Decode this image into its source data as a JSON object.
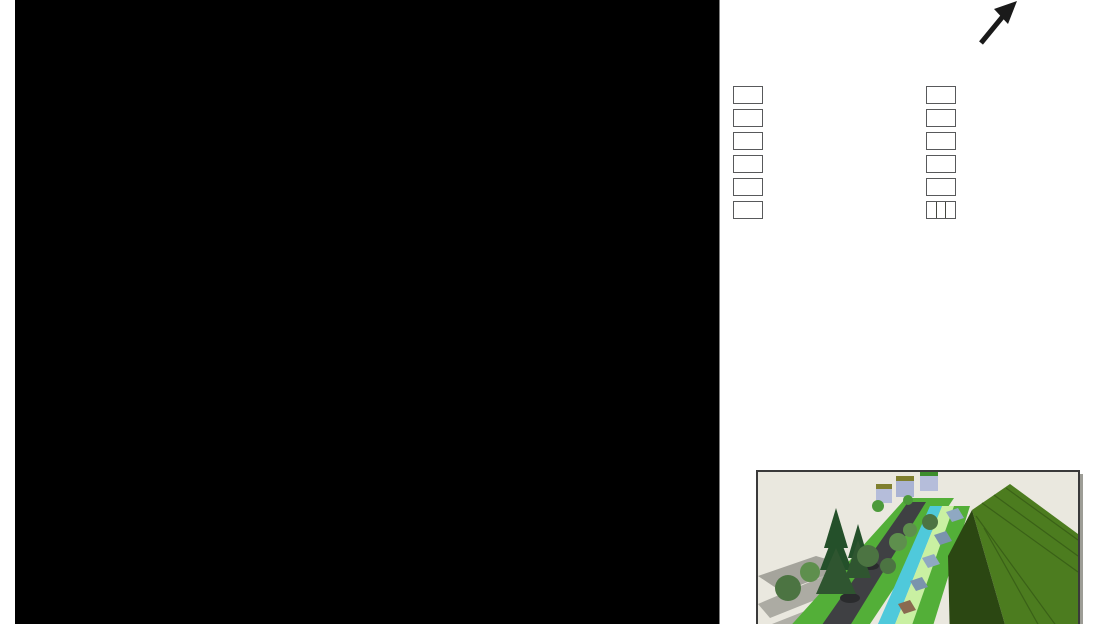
{
  "scale_label": "Schaal 1:250",
  "north_label": "N",
  "palette": {
    "groendak1": "#179551",
    "groendak2": "#6f6b33",
    "kas-light": "#bce2f1",
    "kas-dark": "#9cbdcb",
    "openbaar": "#8cc75b",
    "water": "#199fdb",
    "wegen": "#57585b",
    "voetpad": "#7f8285",
    "brug": "#8a6a50",
    "onverhard": "#dee67c",
    "verhard": "#acacae",
    "parkeer": "#8f8e75",
    "tree-bright": "#1cb053",
    "tree-mid": "#4e8c36",
    "tree-dark": "#546f4b",
    "outline": "#2b2b2b"
  },
  "legend": {
    "column1": [
      {
        "label": "Groendak type 1",
        "color": "#179551"
      },
      {
        "label": "Groendak type 2",
        "color": "#6f6b33"
      },
      {
        "label": "Kasgedeelte",
        "color": "#c9e6f4"
      },
      {
        "label": "Openbare buitenruimte",
        "color": "#8cc75b"
      },
      {
        "label": "Water",
        "color": "#199fdb"
      },
      {
        "label": "Wegen",
        "color": "#57585b"
      }
    ],
    "column2": [
      {
        "label": "Voetpaden",
        "color": "#7f8285"
      },
      {
        "label": "Brug",
        "color": "#8a6a50"
      },
      {
        "label": "Kavel onverhard",
        "color": "#dee67c"
      },
      {
        "label": "Kavel verhard",
        "color": "#acacae"
      },
      {
        "label": "Parkeerplaats",
        "color": "#8f8e75"
      },
      {
        "label": "Verschillende soorten bomen",
        "colors": [
          "#4e8c36",
          "#5d7052",
          "#22b14c"
        ]
      }
    ]
  },
  "description": {
    "lines": [
      "De afbeelding links is een detailtekening van de ingegraven",
      "woningen en de twee-onder-één kap woning op schaal",
      "1:250. Te zien is ook de 2 groene stroken langs de weg, met",
      "daaraan langsparkeren, de verschillende type groene daken",
      "en de variatie in bomen."
    ]
  },
  "map": {
    "greenhouses": [
      {
        "x1": 55.5,
        "x2": 205.5,
        "y1": 43,
        "y2": 89,
        "pattern": "dddddlllll"
      },
      {
        "x1": 262,
        "x2": 415,
        "y1": 43,
        "y2": 89,
        "pattern": "ddlddlldll"
      },
      {
        "x1": 472,
        "x2": 622,
        "y1": 43,
        "y2": 89,
        "pattern": "dddddlllll"
      },
      {
        "x1": 680,
        "x2": 719.5,
        "y1": 43,
        "y2": 89,
        "pattern": "dll"
      }
    ],
    "yellow_squares": [
      87,
      295,
      502,
      707
    ],
    "yellow_bars": [
      [
        87,
        205.5
      ],
      [
        295,
        413
      ],
      [
        502,
        622
      ],
      [
        707,
        719.5
      ]
    ],
    "block_lines": [
      205.5,
      415,
      622
    ],
    "bridges": [
      [
        15,
        43
      ],
      [
        208,
        250
      ],
      [
        415,
        457
      ],
      [
        624,
        666
      ]
    ],
    "strip_segments": [
      [
        43,
        208
      ],
      [
        250,
        415
      ],
      [
        457,
        624
      ],
      [
        666,
        719.5
      ]
    ],
    "parkeer": [
      [
        18,
        85,
        327,
        353
      ],
      [
        293,
        370,
        327,
        353
      ],
      [
        483,
        553,
        325,
        354
      ],
      [
        557,
        628,
        325,
        354
      ],
      [
        632,
        703,
        325,
        354
      ]
    ],
    "trees": [
      {
        "cx": 105,
        "cy": 252,
        "rx": 30,
        "ry": 42,
        "tone": "bright"
      },
      {
        "cx": 255,
        "cy": 238,
        "rx": 61,
        "ry": 62,
        "tone": "mid"
      },
      {
        "cx": 365,
        "cy": 255,
        "rx": 32,
        "ry": 43,
        "tone": "bright"
      },
      {
        "cx": 602,
        "cy": 266,
        "rx": 45,
        "ry": 52,
        "tone": "dark"
      },
      {
        "cx": 190,
        "cy": 368,
        "rx": 45,
        "ry": 45,
        "tone": "dark"
      },
      {
        "cx": 536,
        "cy": 451,
        "rx": 60,
        "ry": 60,
        "tone": "mid"
      },
      {
        "cx": 668,
        "cy": 453,
        "rx": 30,
        "ry": 30,
        "tone": "bright"
      },
      {
        "cx": 725,
        "cy": 391,
        "rx": 29,
        "ry": 29,
        "tone": "bright"
      },
      {
        "cx": 656,
        "cy": 583,
        "rx": 60,
        "ry": 60,
        "tone": "mid"
      },
      {
        "cx": 492,
        "cy": 629,
        "rx": 29,
        "ry": 29,
        "tone": "bright"
      }
    ],
    "glass": {
      "row_h": 14.95,
      "cols": [
        {
          "x": 58,
          "w": 29,
          "y": 443.5,
          "rows": "llldddllll"
        },
        {
          "x": 293.5,
          "w": 29,
          "y": 443.5,
          "rows": "lllddlllll"
        }
      ],
      "grids": [
        {
          "x": 87,
          "cw": 22.5,
          "y": 488.2,
          "rows": [
            "dd",
            "dd",
            "dl",
            "ll",
            "ll",
            "ll",
            "ll"
          ]
        },
        {
          "x": 248,
          "cw": 22.5,
          "y": 488.2,
          "rows": [
            "dd",
            "dd",
            "ld",
            "ll",
            "ll",
            "ll",
            "ll"
          ]
        }
      ]
    }
  }
}
